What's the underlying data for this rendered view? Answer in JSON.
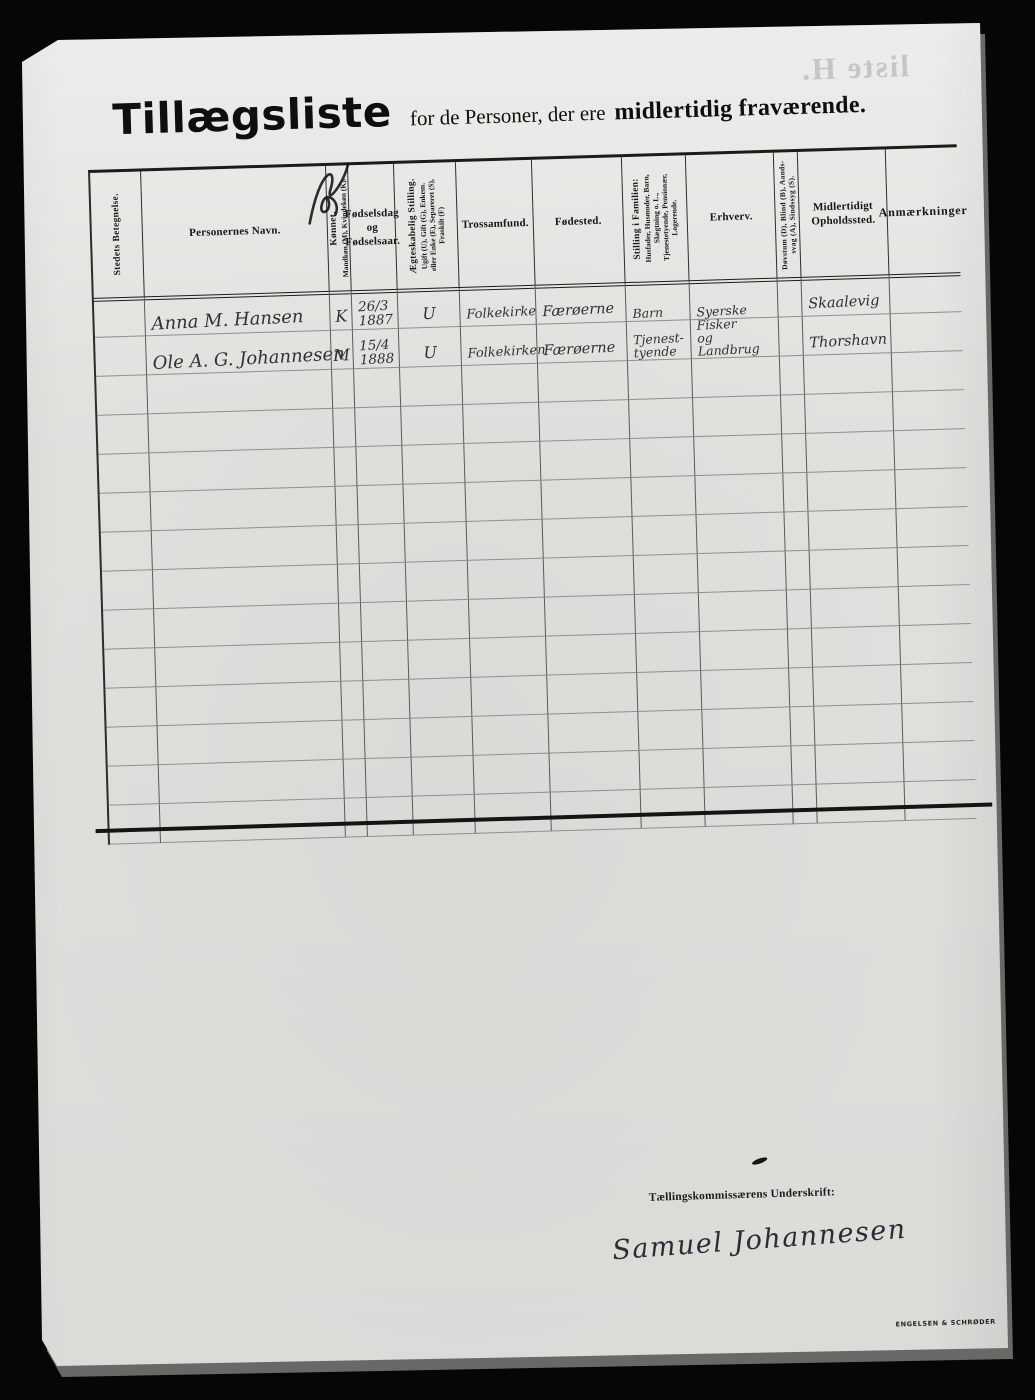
{
  "page": {
    "title_main": "Tillægsliste",
    "title_mid": "for de Personer, der ere",
    "title_emph": "midlertidig fraværende.",
    "bleedthrough": "liste H.",
    "printer_mark": "ENGELSEN & SCHRØDER",
    "paper_color": "#e4e4e1",
    "background_color": "#060606",
    "ink_color": "#161616",
    "handwriting_color": "#30303a"
  },
  "table": {
    "columns": [
      {
        "id": "stedets-betegnelse",
        "label": "Stedets Betegnelse.",
        "vertical": true
      },
      {
        "id": "personernes-navn",
        "label": "Personernes  Navn."
      },
      {
        "id": "konnet",
        "label": "Kønnet.",
        "sub": "Mandkøn (M), Kvindekøn (K).",
        "vertical": true
      },
      {
        "id": "fodselsdag",
        "label": "Fødselsdag\nog\nFødselsaar."
      },
      {
        "id": "aegteskabelig-stilling",
        "label": "Ægteskabelig Stilling.",
        "sub": "Ugift (U), Gift (G), Enkem.\neller Enke (E), Separeret (S),\nFraskilt (F)",
        "vertical": true
      },
      {
        "id": "trossamfund",
        "label": "Trossamfund."
      },
      {
        "id": "fodested",
        "label": "Fødested."
      },
      {
        "id": "stilling-i-familien",
        "label": "Stilling i Familien:",
        "sub": "Husfader, Husmoder, Barn,\nSlægtning o. L.,\nTjenestetyende, Pensionær,\nLogerende.",
        "vertical": true
      },
      {
        "id": "erhverv",
        "label": "Erhverv."
      },
      {
        "id": "dovstum-blind",
        "label": "Døvstum (D), Blind (B), Aands-\nsvag (A), Sindssyg (S).",
        "vertical": true,
        "small": true
      },
      {
        "id": "midlertidigt-opholdssted",
        "label": "Midlertidigt\nOpholdssted."
      },
      {
        "id": "anmaerkninger",
        "label": "Anmærkninger"
      }
    ],
    "rows": [
      [
        "",
        "Anna M. Hansen",
        "K",
        "26/3\n1887",
        "U",
        "Folkekirke",
        "Færøerne",
        "Barn",
        "Syerske",
        "",
        "Skaalevig",
        ""
      ],
      [
        "",
        "Ole A. G. Johannesen",
        "M",
        "15/4\n1888",
        "U",
        "Folkekirken",
        "Færøerne",
        "Tjenest-\ntyende",
        "Fisker\nog Landbrug",
        "",
        "Thorshavn",
        ""
      ],
      [
        "",
        "",
        "",
        "",
        "",
        "",
        "",
        "",
        "",
        "",
        "",
        ""
      ],
      [
        "",
        "",
        "",
        "",
        "",
        "",
        "",
        "",
        "",
        "",
        "",
        ""
      ],
      [
        "",
        "",
        "",
        "",
        "",
        "",
        "",
        "",
        "",
        "",
        "",
        ""
      ],
      [
        "",
        "",
        "",
        "",
        "",
        "",
        "",
        "",
        "",
        "",
        "",
        ""
      ],
      [
        "",
        "",
        "",
        "",
        "",
        "",
        "",
        "",
        "",
        "",
        "",
        ""
      ],
      [
        "",
        "",
        "",
        "",
        "",
        "",
        "",
        "",
        "",
        "",
        "",
        ""
      ],
      [
        "",
        "",
        "",
        "",
        "",
        "",
        "",
        "",
        "",
        "",
        "",
        ""
      ],
      [
        "",
        "",
        "",
        "",
        "",
        "",
        "",
        "",
        "",
        "",
        "",
        ""
      ],
      [
        "",
        "",
        "",
        "",
        "",
        "",
        "",
        "",
        "",
        "",
        "",
        ""
      ],
      [
        "",
        "",
        "",
        "",
        "",
        "",
        "",
        "",
        "",
        "",
        "",
        ""
      ],
      [
        "",
        "",
        "",
        "",
        "",
        "",
        "",
        "",
        "",
        "",
        "",
        ""
      ],
      [
        "",
        "",
        "",
        "",
        "",
        "",
        "",
        "",
        "",
        "",
        "",
        ""
      ]
    ]
  },
  "footer": {
    "signature_label": "Tællingskommissærens Underskrift:",
    "signature": "Samuel Johannesen"
  }
}
